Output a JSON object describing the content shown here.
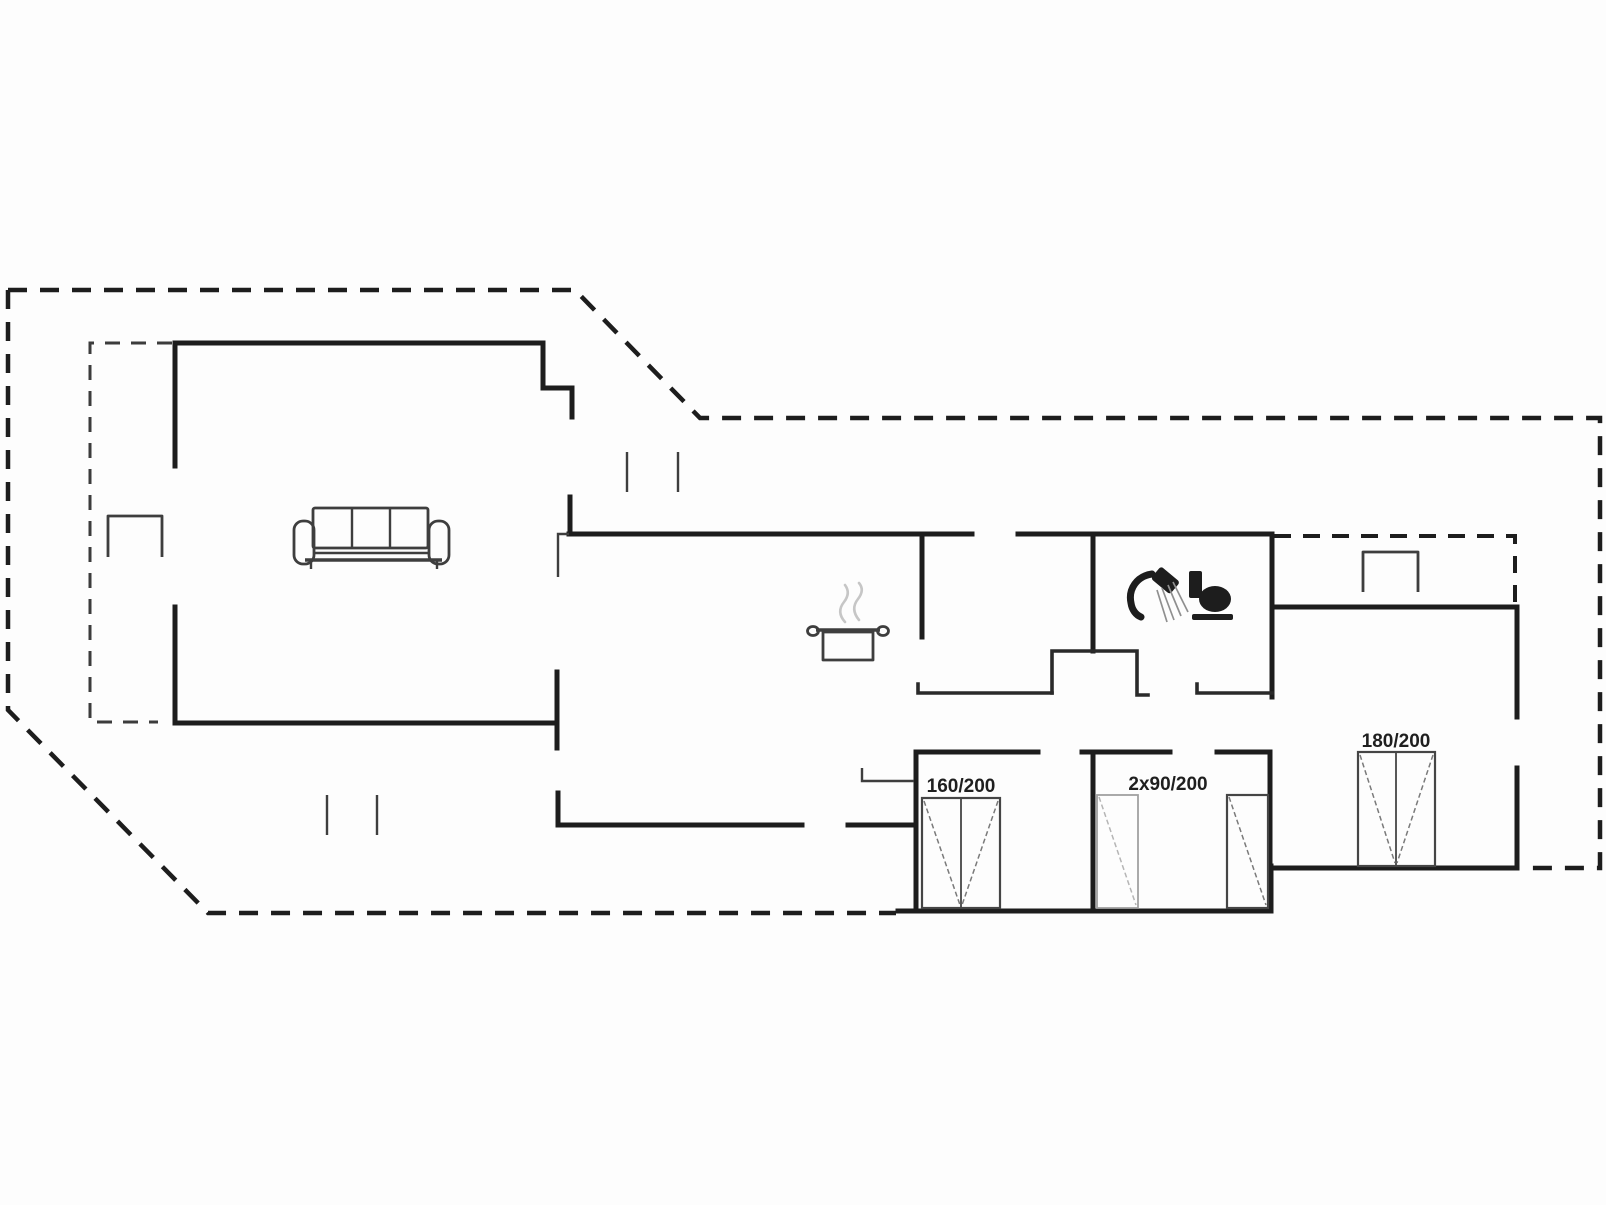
{
  "title": "Holiday house floor plan",
  "colors": {
    "bg": "#fdfdfd",
    "wall": "#1d1d1d",
    "line": "#3e3e3e",
    "steam": "#c6c6c6",
    "label": "#1f1f1f"
  },
  "beds": [
    {
      "name": "double-bed-160x200",
      "label": "160/200"
    },
    {
      "name": "twin-beds-2x90x200",
      "label": "2x90/200"
    },
    {
      "name": "double-bed-180x200",
      "label": "180/200"
    }
  ],
  "icons": [
    {
      "name": "sofa-icon"
    },
    {
      "name": "cooking-pot-icon"
    },
    {
      "name": "shower-icon"
    },
    {
      "name": "toilet-icon"
    },
    {
      "name": "outdoor-table-icon"
    },
    {
      "name": "outdoor-bench-icon"
    },
    {
      "name": "window-marker-icon"
    }
  ]
}
